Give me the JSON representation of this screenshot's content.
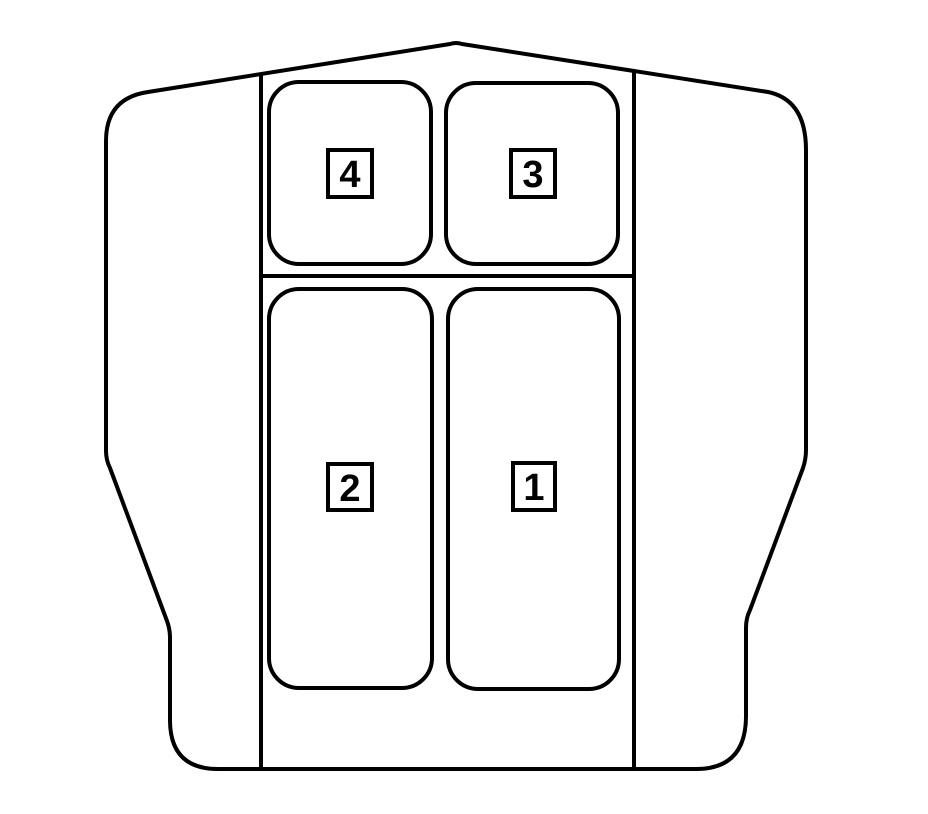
{
  "canvas": {
    "width": 928,
    "height": 814,
    "background": "#ffffff"
  },
  "colors": {
    "line": "#000000",
    "fill": "#ffffff"
  },
  "compartments": [
    {
      "label": "4",
      "position": "top-left"
    },
    {
      "label": "3",
      "position": "top-right"
    },
    {
      "label": "2",
      "position": "bottom-left"
    },
    {
      "label": "1",
      "position": "bottom-right"
    }
  ]
}
